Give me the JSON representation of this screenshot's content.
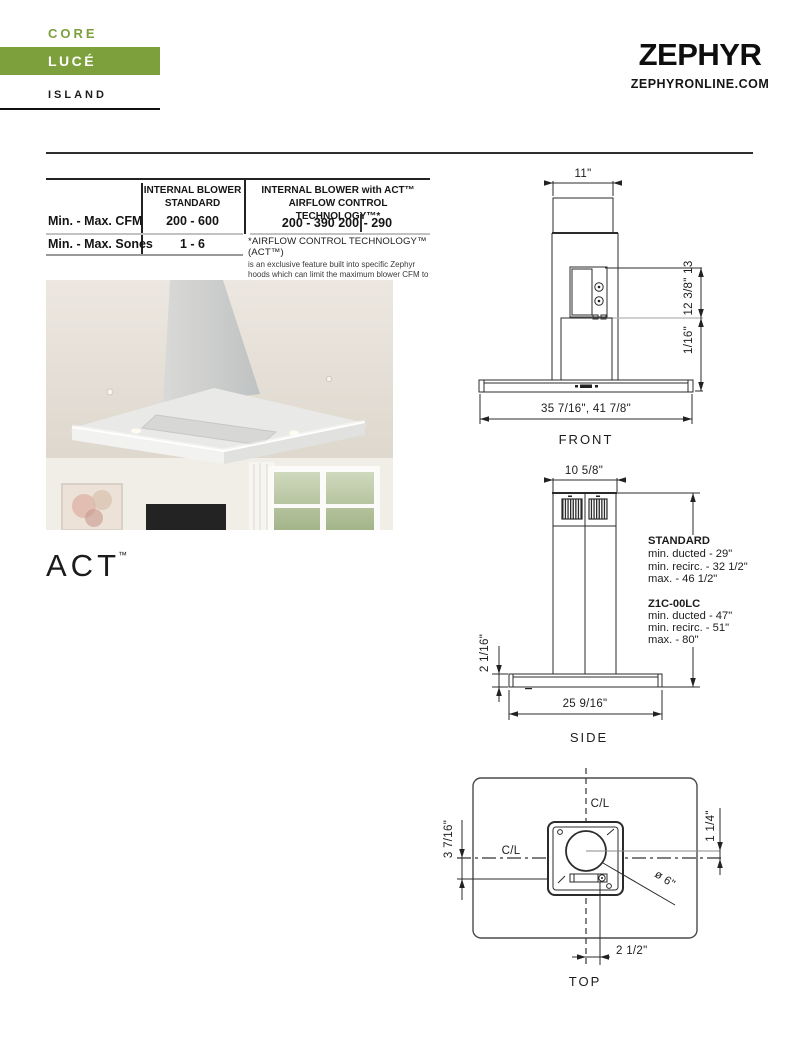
{
  "theme": {
    "accent_green": "#7da03c"
  },
  "brand": {
    "collection": "CORE",
    "model": "LUCÉ",
    "mount_type": "ISLAND"
  },
  "logo": {
    "wordmark": "ZEPHYR",
    "website": "ZEPHYRONLINE.COM"
  },
  "spec_table": {
    "header_standard_line1": "INTERNAL BLOWER",
    "header_standard_line2": "STANDARD",
    "header_act_line1": "INTERNAL BLOWER with ACT™",
    "header_act_line2": "AIRFLOW CONTROL TECHNOLOGY™*",
    "cfm_label": "Min. - Max. CFM",
    "cfm_standard": "200 - 600",
    "cfm_act_left": "200 - 390 200",
    "cfm_act_right": "- 290",
    "sones_label": "Min. - Max. Sones",
    "sones_standard": "1 - 6",
    "footnote_title": "*AIRFLOW CONTROL TECHNOLOGY™ (ACT™)",
    "footnote_body": "is an exclusive feature built into specific Zephyr hoods which can limit the maximum blower CFM to meet local code requirements."
  },
  "act_wordmark": {
    "text": "ACT",
    "tm": "™"
  },
  "front_view": {
    "label": "FRONT",
    "dim_duct_width": "11\"",
    "dim_height_upper": "12 3/8\" 13",
    "dim_height_lower": "1/16\"",
    "dim_body_width": "35 7/16\", 41 7/8\""
  },
  "side_view": {
    "label": "SIDE",
    "dim_chimney_depth": "10 5/8\"",
    "dim_canopy_height": "2 1/16\"",
    "dim_canopy_depth": "25 9/16\"",
    "standard_title": "STANDARD",
    "standard_line1": "min. ducted - 29\"",
    "standard_line2": "min. recirc. - 32 1/2\"",
    "standard_line3": "max. - 46 1/2\"",
    "model_title": "Z1C-00LC",
    "model_line1": "min. ducted - 47\"",
    "model_line2": "min. recirc. - 51\"",
    "model_line3": "max. - 80\""
  },
  "top_view": {
    "label": "TOP",
    "centerline_top": "C/L",
    "centerline_left": "C/L",
    "dim_offset_left": "3 7/16\"",
    "dim_offset_right": "1 1/4\"",
    "dim_duct_diameter": "ø 6\"",
    "dim_offset_bottom": "2 1/2\""
  }
}
